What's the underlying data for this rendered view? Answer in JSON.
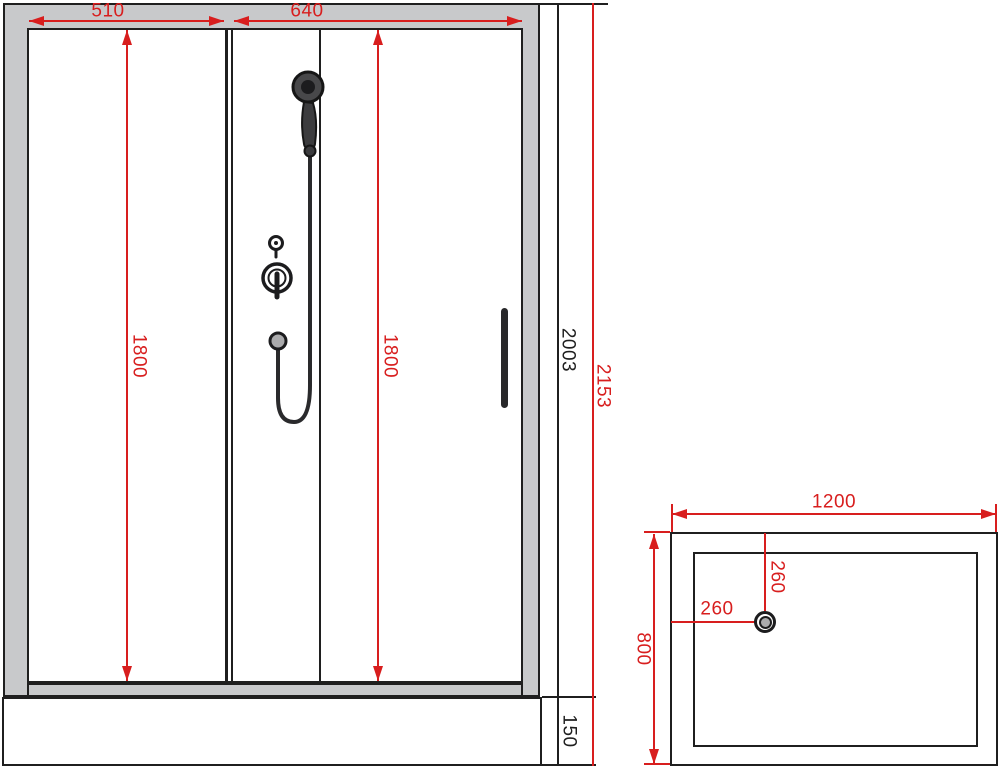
{
  "colors": {
    "dimension_red": "#d81e1e",
    "frame_gray": "#c8c9cb",
    "line_black": "#1f1f1f",
    "fixture_dark": "#3c3c3e",
    "drain_gray": "#ababad",
    "glass_white": "#ffffff"
  },
  "front_view": {
    "dimensions": {
      "left_panel_width": "510",
      "door_width": "640",
      "left_glass_height": "1800",
      "right_glass_height": "1800",
      "cabin_height": "2003",
      "overall_height": "2153",
      "tray_height": "150"
    }
  },
  "top_view": {
    "dimensions": {
      "tray_width": "1200",
      "tray_depth": "800",
      "drain_offset_top": "260",
      "drain_offset_left": "260"
    }
  }
}
